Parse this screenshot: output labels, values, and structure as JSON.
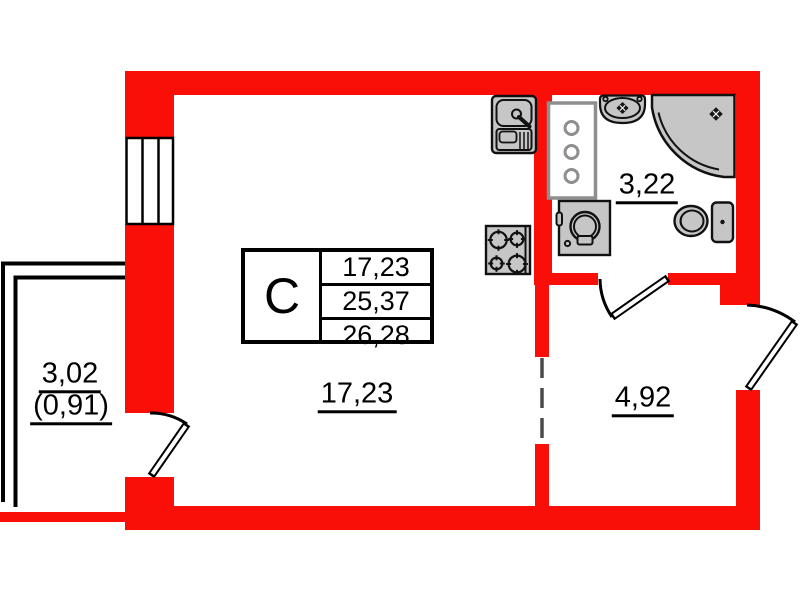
{
  "unit_table": {
    "type_label": "С",
    "rows": [
      "17,23",
      "25,37",
      "26,28"
    ]
  },
  "room_labels": {
    "living": "17,23",
    "bathroom": "3,22",
    "hall": "4,92",
    "balcony": "3,02",
    "balcony_reduced": "(0,91)"
  },
  "fixtures": [
    "kitchen-sink",
    "ventilation-shaft",
    "bathroom-sink",
    "corner-shower",
    "washing-machine",
    "toilet",
    "stove"
  ],
  "colors": {
    "wall_red": "#fa0e08",
    "outline_black": "#111111",
    "fixture_gray": "#c6c6c6",
    "shaft_gray": "#8e8e8e",
    "dash_gray": "#4a4a4a"
  }
}
